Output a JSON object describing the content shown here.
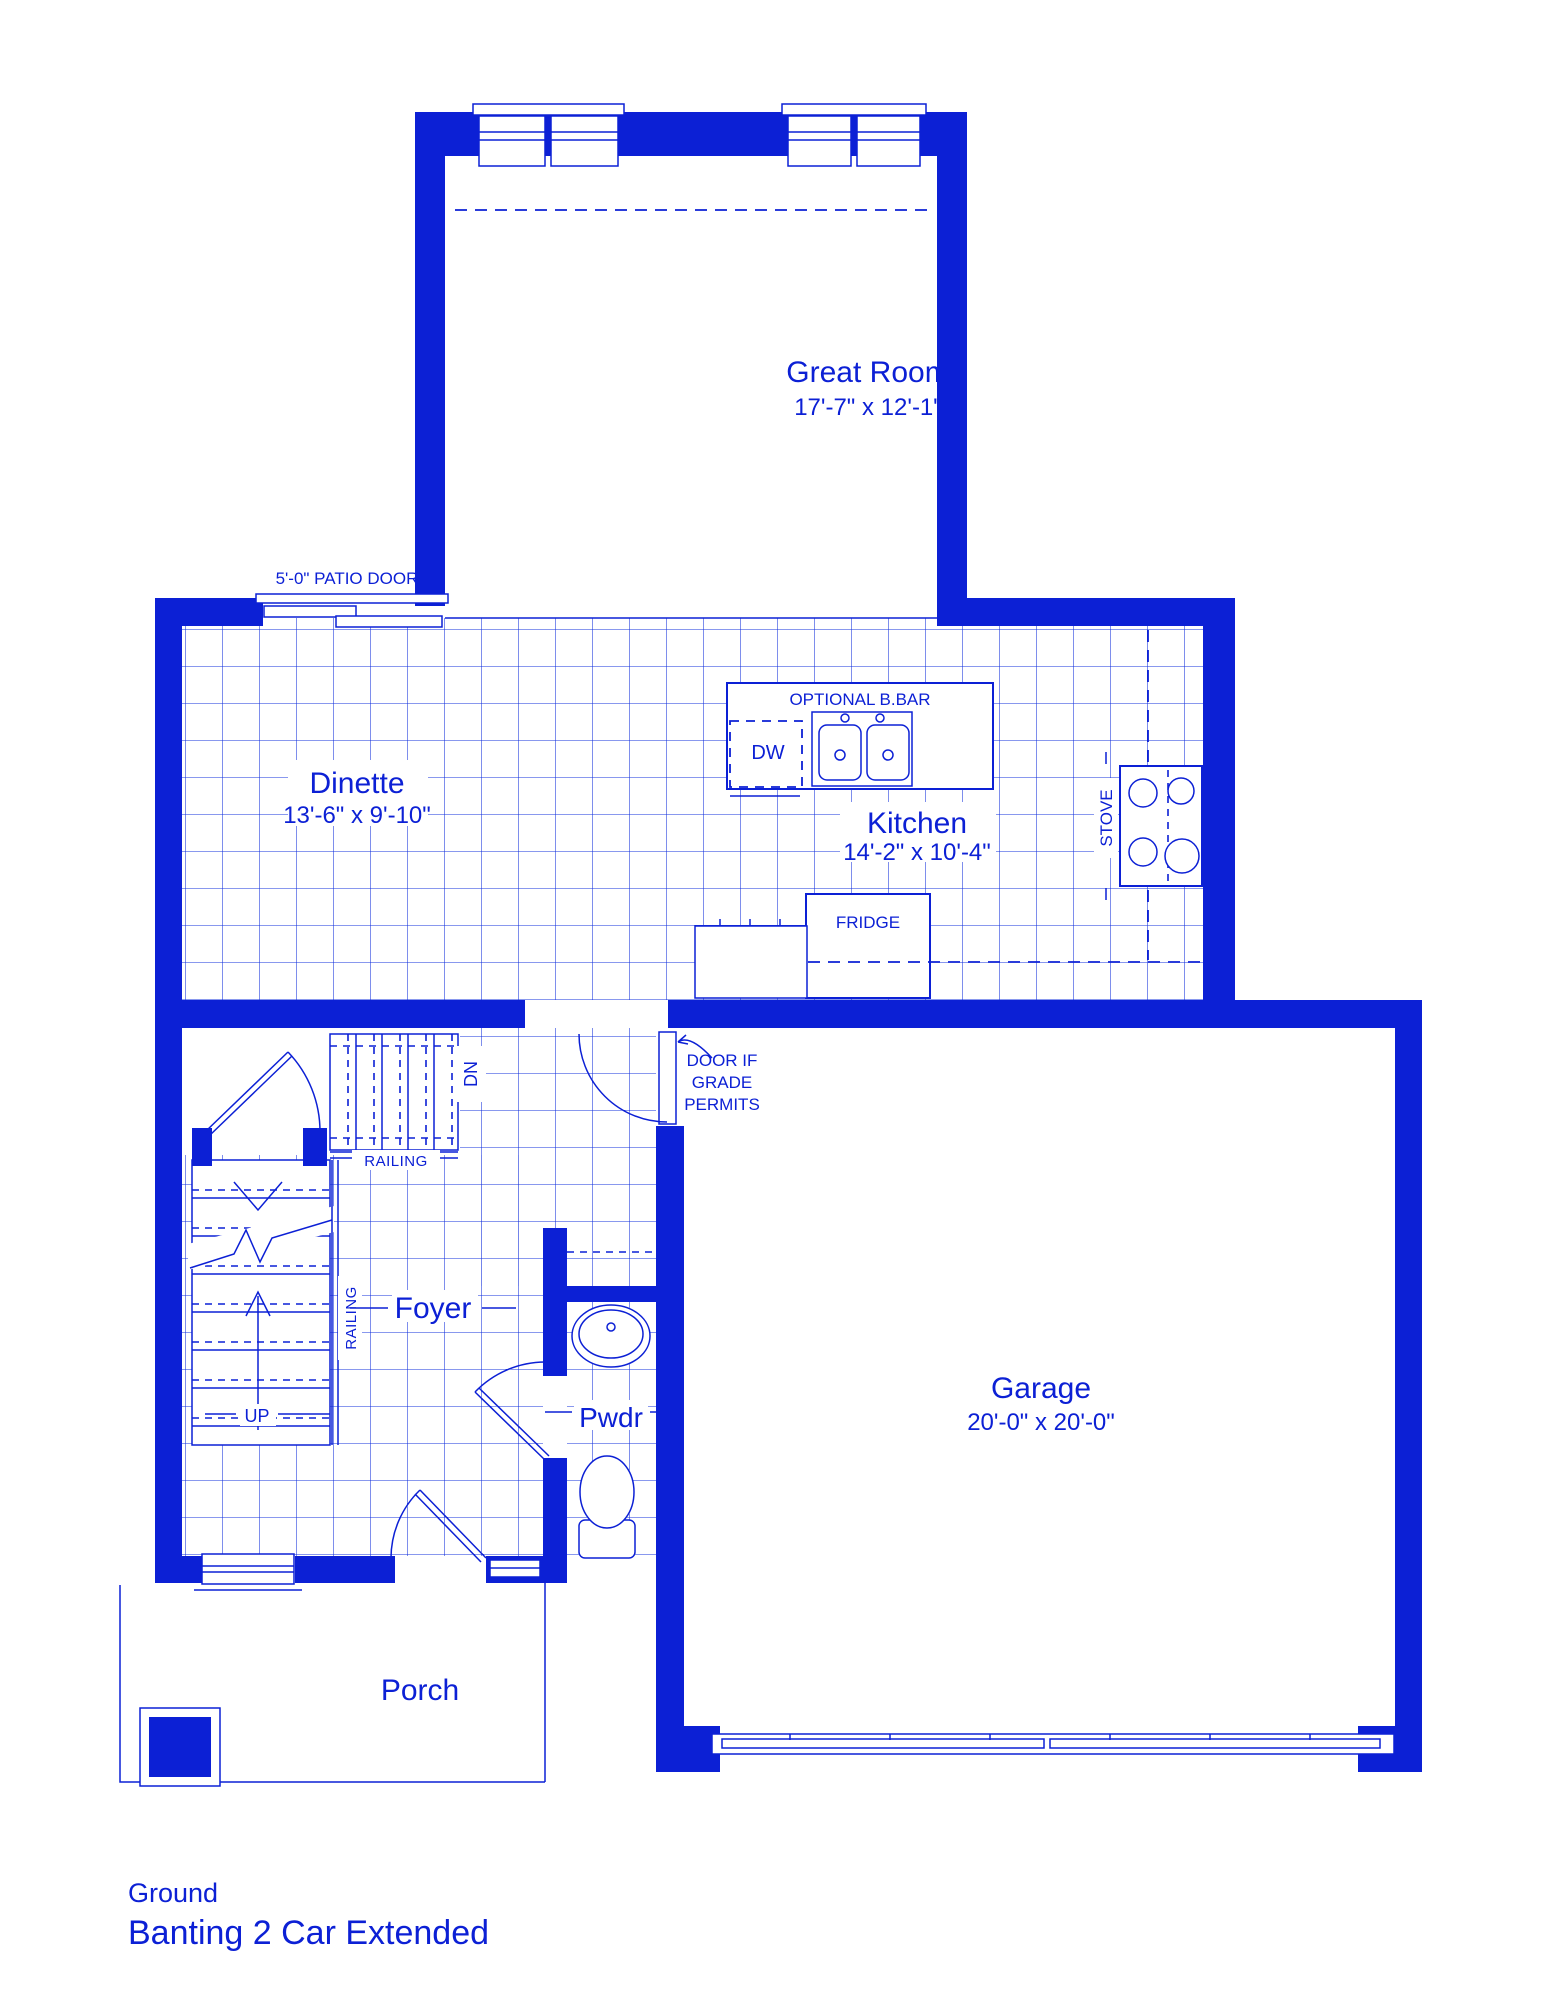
{
  "plan": {
    "floor_label": "Ground",
    "plan_name": "Banting 2 Car Extended"
  },
  "rooms": {
    "great_room": {
      "name": "Great Room",
      "dims": "17'-7\" x 12'-1\""
    },
    "dinette": {
      "name": "Dinette",
      "dims": "13'-6\" x 9'-10\""
    },
    "kitchen": {
      "name": "Kitchen",
      "dims": "14'-2\" x 10'-4\""
    },
    "garage": {
      "name": "Garage",
      "dims": "20'-0\" x 20'-0\""
    },
    "foyer": {
      "name": "Foyer"
    },
    "powder_room": {
      "name": "Pwdr"
    },
    "porch": {
      "name": "Porch"
    }
  },
  "annotations": {
    "patio_door": "5'-0\" PATIO DOOR",
    "optional_bbar": "OPTIONAL B.BAR",
    "dishwasher": "DW",
    "stove": "STOVE",
    "fridge": "FRIDGE",
    "grade_door_line1": "DOOR IF",
    "grade_door_line2": "GRADE",
    "grade_door_line3": "PERMITS",
    "stairs_down": "DN",
    "stairs_up": "UP",
    "railing_stairs": "RAILING",
    "railing_foyer": "RAILING"
  },
  "colors": {
    "line_blue": "#0c20d5",
    "background": "#ffffff"
  }
}
